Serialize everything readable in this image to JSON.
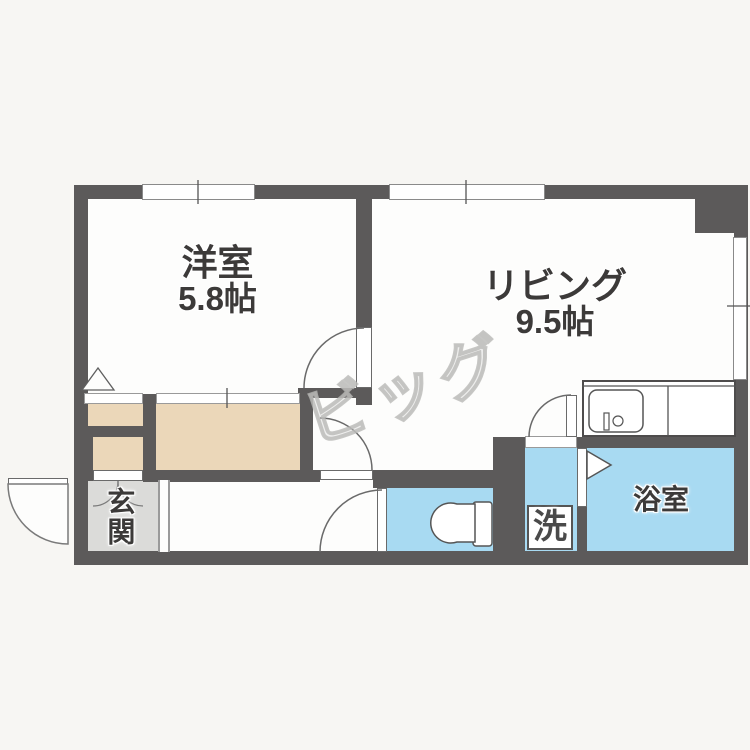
{
  "floorplan": {
    "title": "apartment-floorplan",
    "watermark": {
      "text": "ビッグ"
    },
    "rooms": {
      "western_room": {
        "label": "洋室",
        "size": "5.8帖"
      },
      "living": {
        "label": "リビング",
        "size": "9.5帖"
      },
      "bathroom": {
        "label": "浴室"
      },
      "laundry": {
        "label": "洗"
      },
      "entrance": {
        "label": "玄関"
      }
    },
    "colors": {
      "wall": "#5c5a5a",
      "water_area": "#a8daf2",
      "closet": "#ebd7b9",
      "entrance_floor": "#dbdbd9",
      "floor": "#fdfdfc",
      "background": "#f7f6f3"
    },
    "icons": {
      "kitchen_sink": "sink-icon",
      "faucet": "faucet-icon",
      "toilet": "toilet-icon",
      "door_swings": "door-swing-arc-icon",
      "bath_door": "folding-door-triangle-icon",
      "closet_marker": "triangle-marker-icon",
      "double_door_cabinet": "double-door-arc-icon",
      "windows": "window-icon"
    }
  }
}
